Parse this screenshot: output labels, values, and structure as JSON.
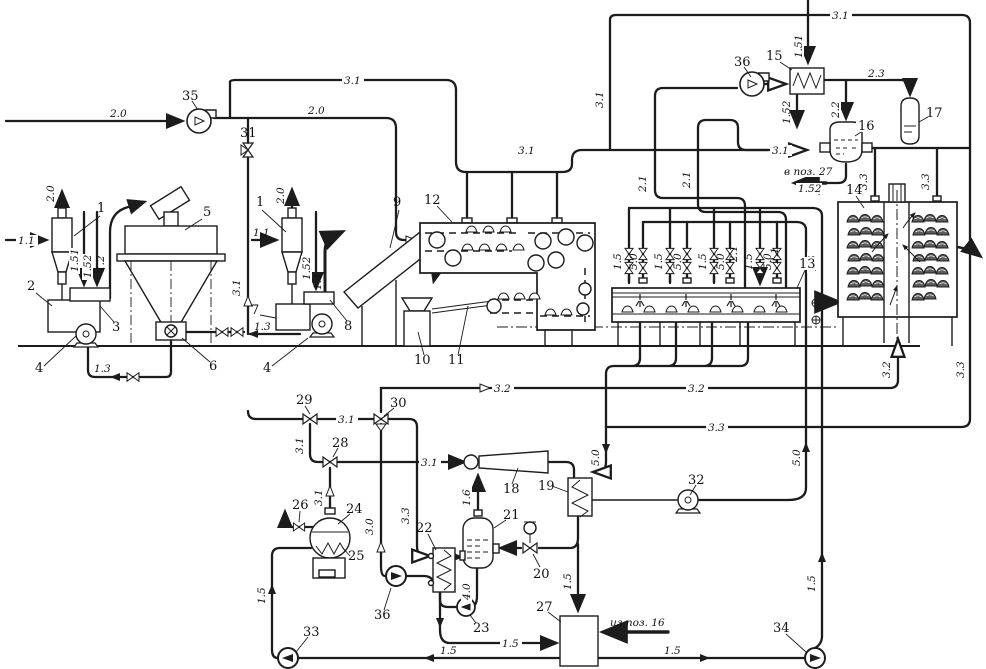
{
  "colors": {
    "ink": "#1c1c1c",
    "background": "#ffffff"
  },
  "streams": {
    "s1_1": "1.1",
    "s1_2": "1.2",
    "s1_3": "1.3",
    "s1_4": "1.4",
    "s1_5": "1.5",
    "s1_51": "1.51",
    "s1_52": "1.52",
    "s1_6": "1.6",
    "s2_0": "2.0",
    "s2_1": "2.1",
    "s2_2": "2.2",
    "s2_3": "2.3",
    "s3_0": "3.0",
    "s3_1": "3.1",
    "s3_2": "3.2",
    "s3_3": "3.3",
    "s4_0": "4.0",
    "s5_0": "5.0"
  },
  "equipment": {
    "e1": "1",
    "e2": "2",
    "e3": "3",
    "e4": "4",
    "e5": "5",
    "e6": "6",
    "e7": "7",
    "e8": "8",
    "e9": "9",
    "e10": "10",
    "e11": "11",
    "e12": "12",
    "e13": "13",
    "e14": "14",
    "e15": "15",
    "e16": "16",
    "e17": "17",
    "e18": "18",
    "e19": "19",
    "e20": "20",
    "e21": "21",
    "e22": "22",
    "e23": "23",
    "e24": "24",
    "e25": "25",
    "e26": "26",
    "e27": "27",
    "e28": "28",
    "e29": "29",
    "e30": "30",
    "e31": "31",
    "e32": "32",
    "e33": "33",
    "e34": "34",
    "e35": "35",
    "e36": "36"
  },
  "notes": {
    "to_pos_27": "в поз. 27",
    "from_pos_16": "из поз. 16"
  }
}
